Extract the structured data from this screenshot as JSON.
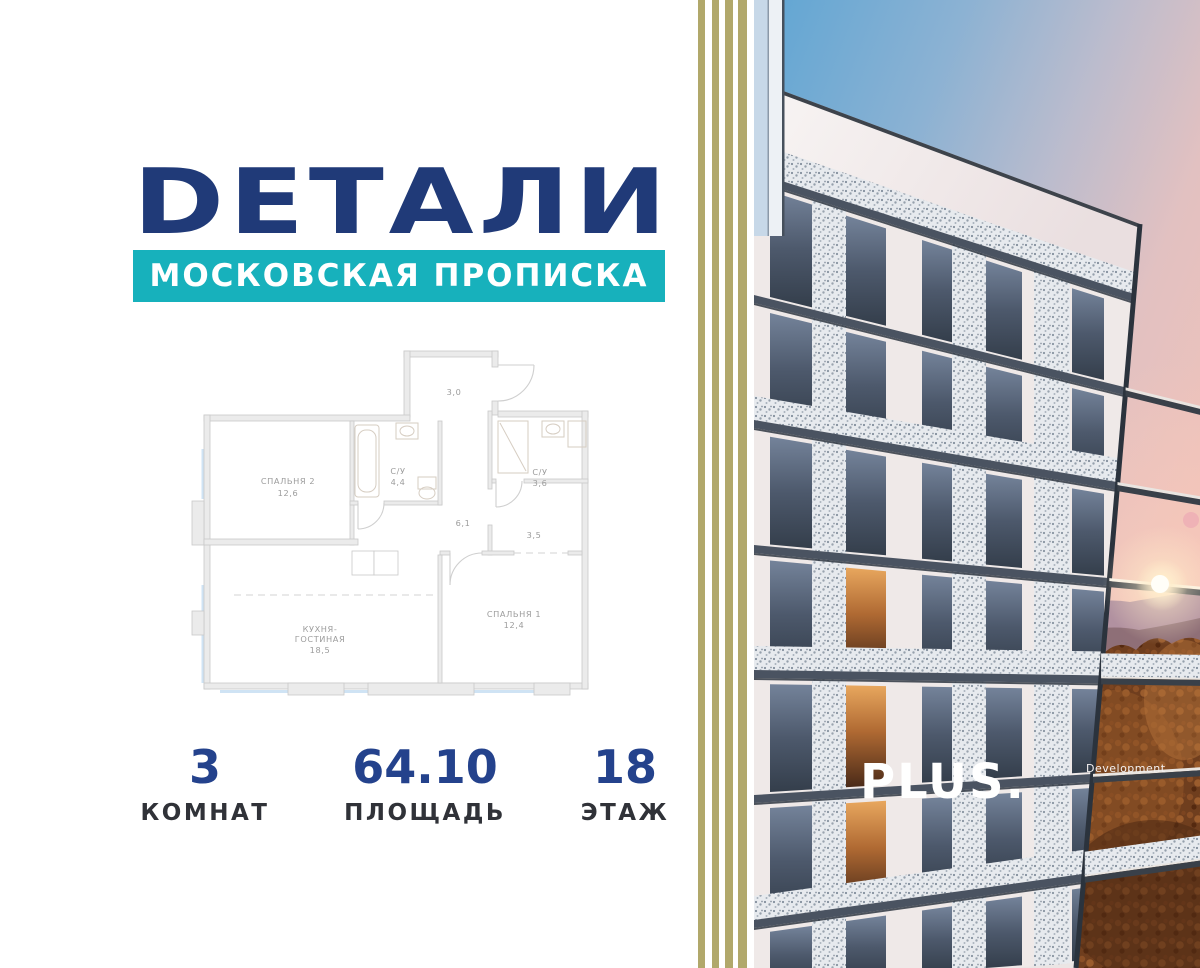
{
  "brand": {
    "logo_text": "DЕТАЛИ",
    "tagline": "МОСКОВСКАЯ ПРОПИСКА"
  },
  "colors": {
    "navy_logo": "#203a78",
    "teal_banner": "#17b1bc",
    "stat_number_navy": "#24428c",
    "stripe_olive": "#b1a86b"
  },
  "floorplan": {
    "hall_top": {
      "area": "3,0"
    },
    "bedroom2": {
      "name": "СПАЛЬНЯ 2",
      "area": "12,6"
    },
    "bath1": {
      "name": "С/У",
      "area": "4,4"
    },
    "bath2": {
      "name": "С/У",
      "area": "3,6"
    },
    "hallway": {
      "area": "6,1"
    },
    "corridor": {
      "area": "3,5"
    },
    "kitchen": {
      "name_line1": "КУХНЯ-",
      "name_line2": "ГОСТИНАЯ",
      "area": "18,5"
    },
    "bedroom1": {
      "name": "СПАЛЬНЯ 1",
      "area": "12,4"
    }
  },
  "stats": {
    "rooms": {
      "value": "3",
      "label": "КОМНАТ"
    },
    "area": {
      "value": "64.10",
      "label": "ПЛОЩАДЬ"
    },
    "floor": {
      "value": "18",
      "label": "ЭТАЖ"
    }
  },
  "developer": {
    "name": "PLUS.",
    "suffix": "Development"
  }
}
